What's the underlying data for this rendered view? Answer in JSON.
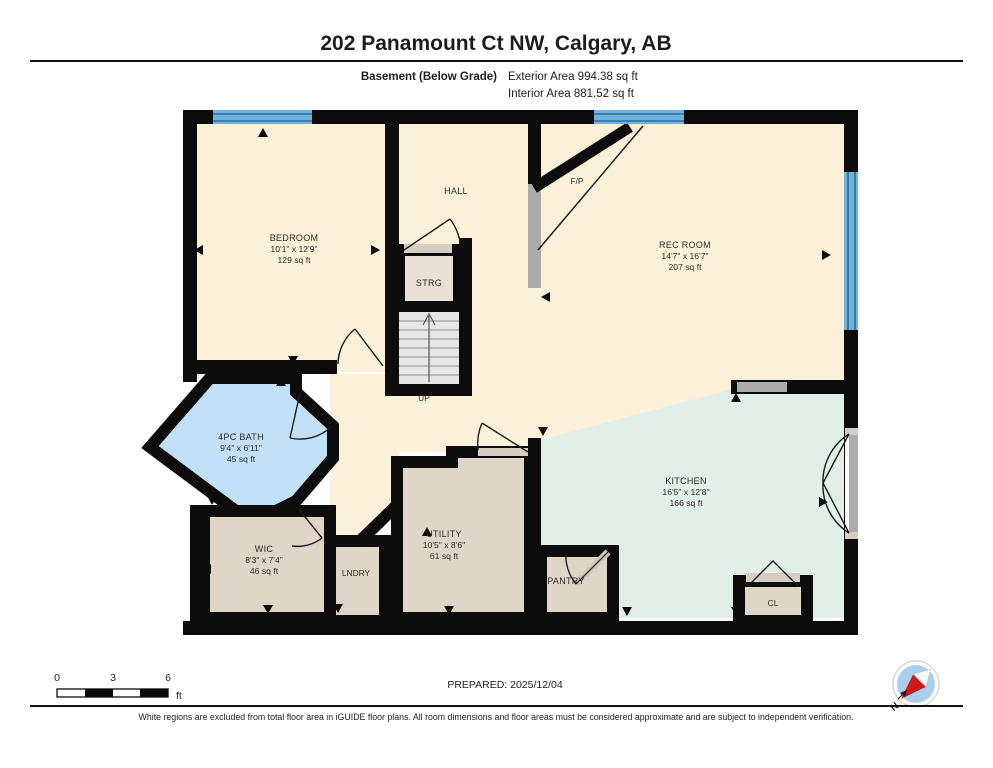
{
  "header": {
    "title": "202 Panamount Ct NW, Calgary, AB",
    "floor_label": "Basement (Below Grade)",
    "exterior_area": "Exterior Area 994.38 sq ft",
    "interior_area": "Interior Area 881.52 sq ft"
  },
  "rooms": {
    "bedroom": {
      "name": "BEDROOM",
      "dims": "10'1\" x 12'9\"",
      "area": "129 sq ft"
    },
    "hall": {
      "name": "HALL"
    },
    "fireplace": {
      "name": "F/P"
    },
    "rec_room": {
      "name": "REC ROOM",
      "dims": "14'7\" x 16'7\"",
      "area": "207 sq ft"
    },
    "strg": {
      "name": "STRG"
    },
    "stairs": {
      "name": "UP"
    },
    "bath": {
      "name": "4PC BATH",
      "dims": "9'4\" x 6'11\"",
      "area": "45 sq ft"
    },
    "wic": {
      "name": "WIC",
      "dims": "8'3\" x 7'4\"",
      "area": "46 sq ft"
    },
    "lndry": {
      "name": "LNDRY"
    },
    "utility": {
      "name": "UTILITY",
      "dims": "10'5\" x 8'6\"",
      "area": "61 sq ft"
    },
    "pantry": {
      "name": "PANTRY"
    },
    "kitchen": {
      "name": "KITCHEN",
      "dims": "16'5\" x 12'8\"",
      "area": "166 sq ft"
    },
    "cl": {
      "name": "CL"
    }
  },
  "footer": {
    "scale": {
      "start": "0",
      "mid": "3",
      "end": "6",
      "unit": "ft"
    },
    "prepared": "PREPARED: 2025/12/04",
    "compass_label": "N",
    "disclaimer": "White regions are excluded from total floor area in iGUIDE floor plans. All room dimensions and floor areas must be considered approximate and are subject to independent verification."
  },
  "colors": {
    "wall": "#0c0c0c",
    "room_cream": "#FAF1D8",
    "room_beige": "#DFD6C8",
    "room_storage": "#E9E1D4",
    "bath_blue": "#C2E0F7",
    "kitchen_mint": "#E2EEE8",
    "window_blue": "#6FB3DE",
    "window_line": "#2B6E9D",
    "half_wall_gray": "#ABABAB",
    "stairs_gray": "#E6E6E6",
    "compass_fill": "#AACFEE",
    "compass_needle_red": "#CC1A14"
  }
}
